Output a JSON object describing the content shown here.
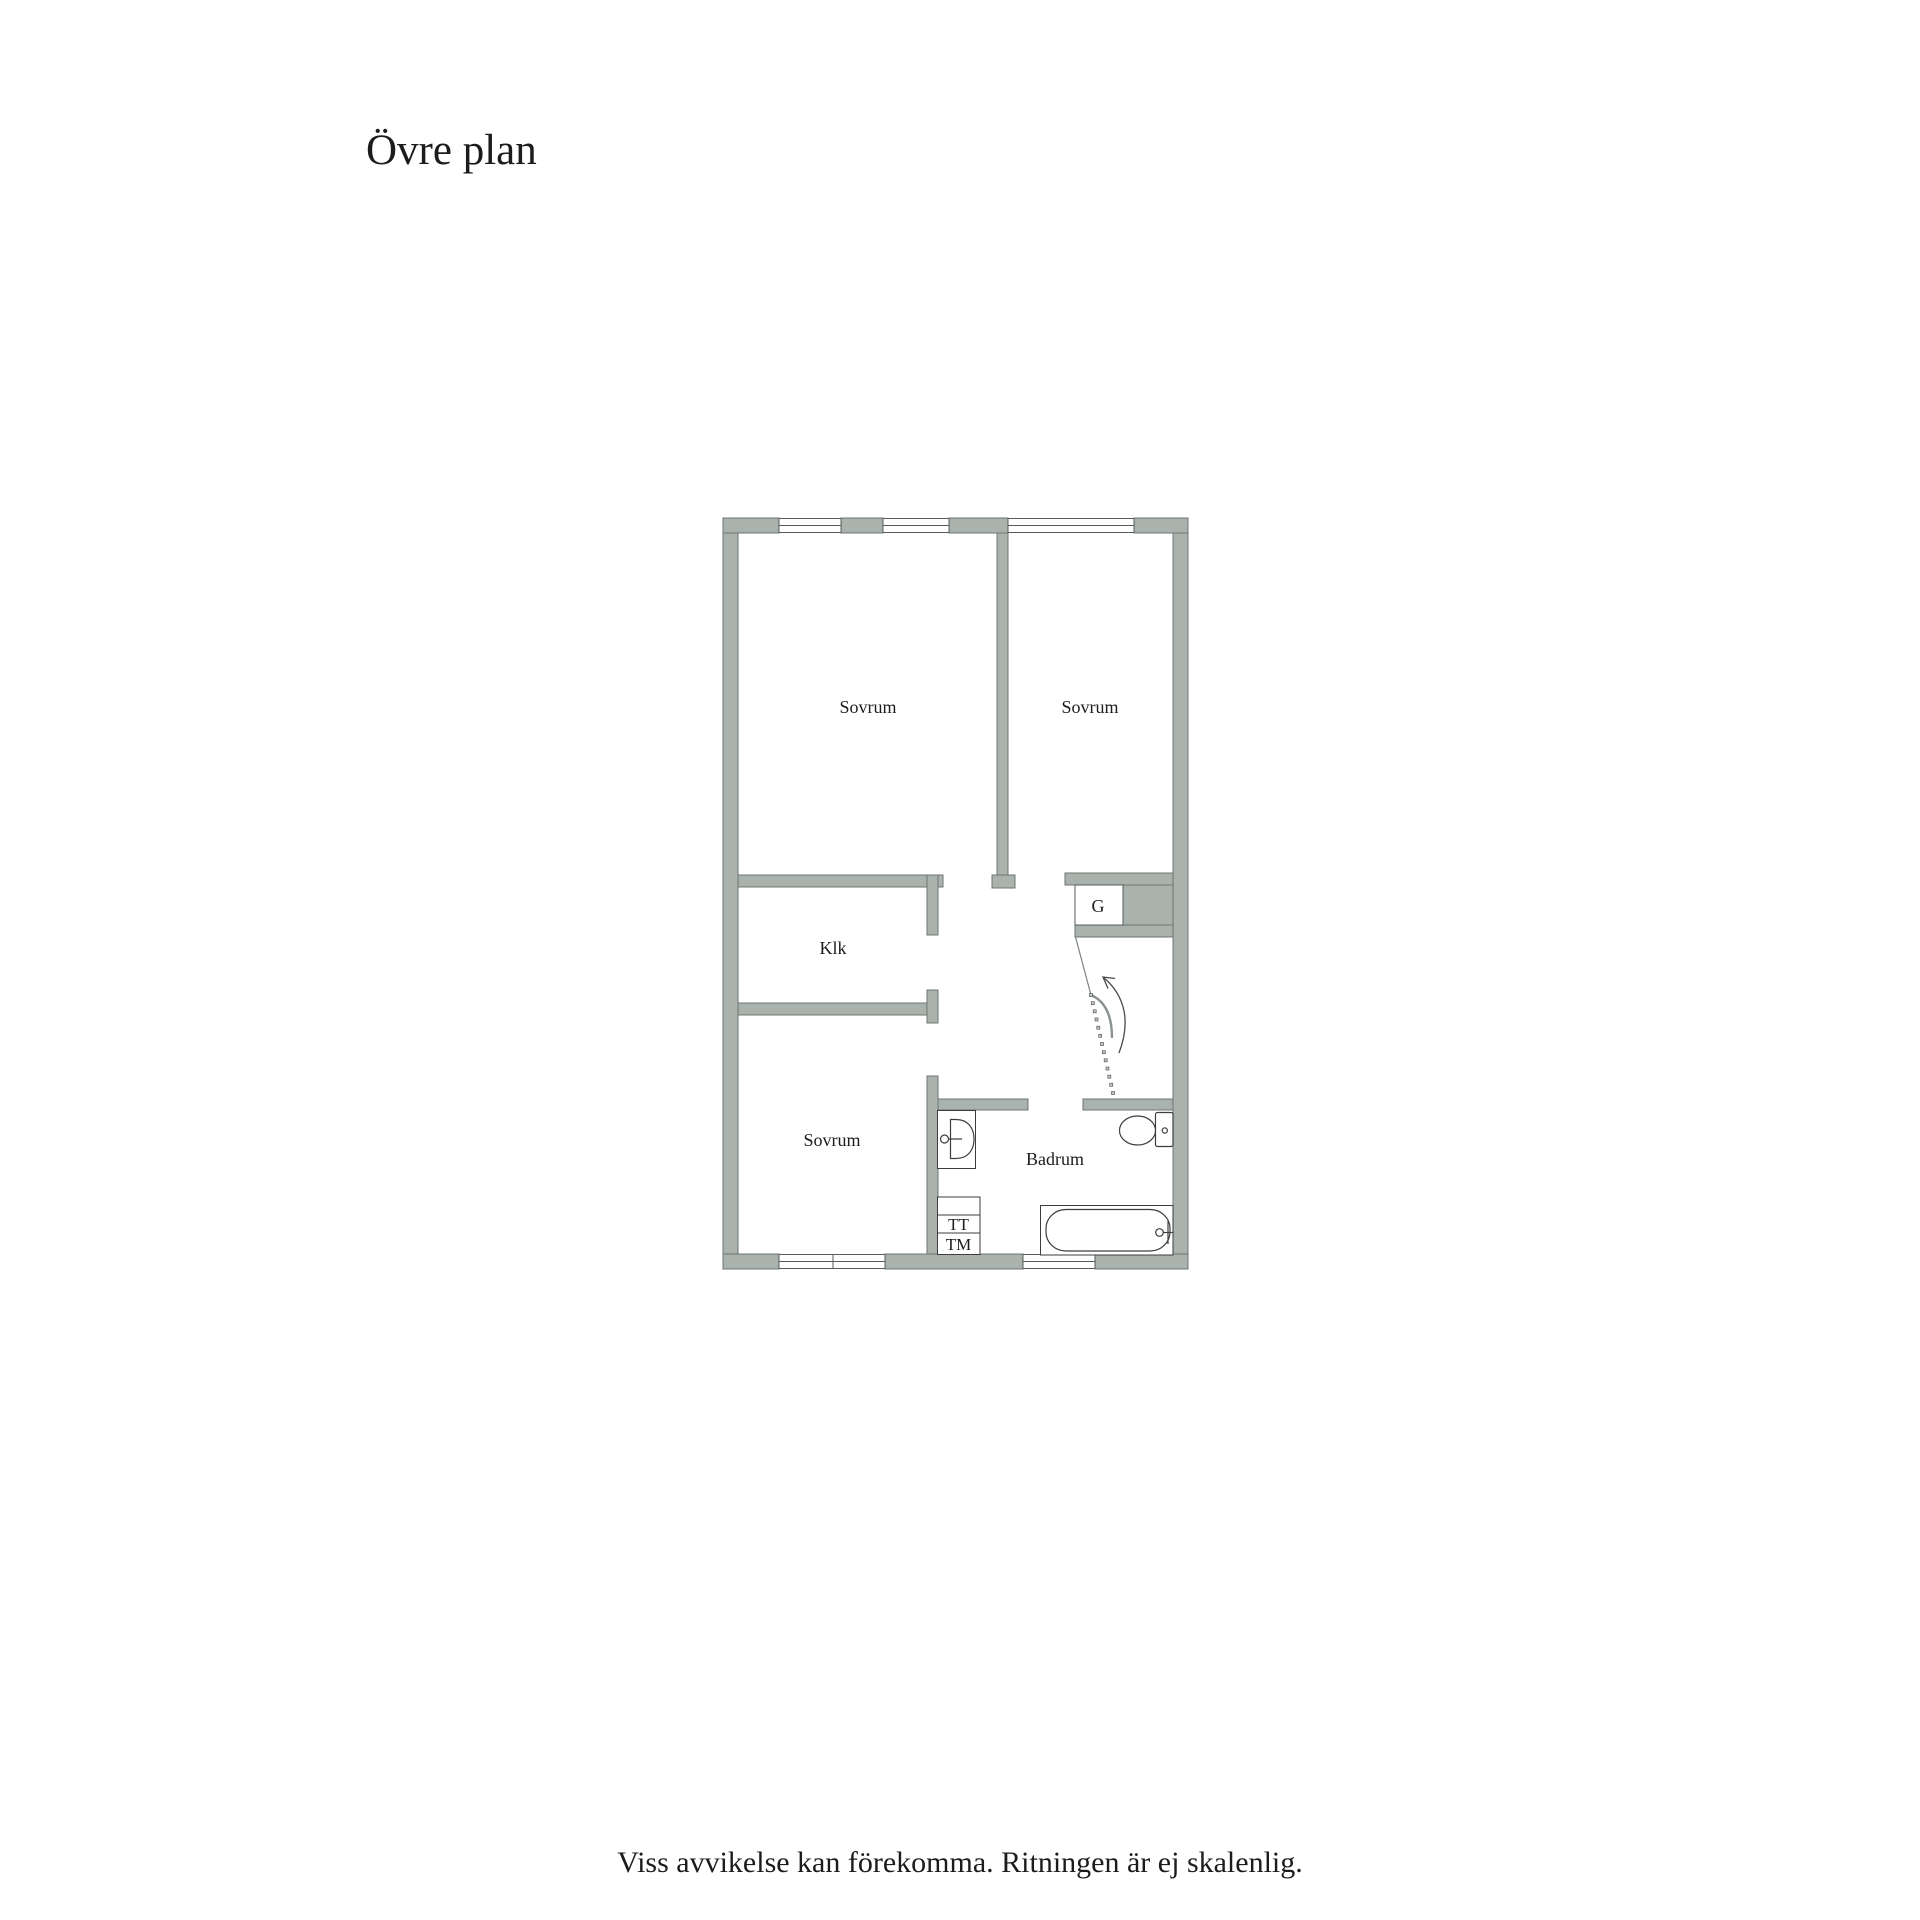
{
  "title": "Övre plan",
  "footer": "Viss avvikelse kan förekomma. Ritningen är ej skalenlig.",
  "colors": {
    "background": "#ffffff",
    "wall_fill": "#a9b2ac",
    "wall_outline": "#6e7672",
    "fixture_outline": "#3d3d3d",
    "text": "#1c1c1a"
  },
  "rooms": {
    "bedroom_top_left": "Sovrum",
    "bedroom_top_right": "Sovrum",
    "closet": "Klk",
    "bedroom_bottom": "Sovrum",
    "bathroom": "Badrum",
    "wardrobe": "G",
    "tumble_dryer": "TT",
    "washing_machine": "TM"
  }
}
